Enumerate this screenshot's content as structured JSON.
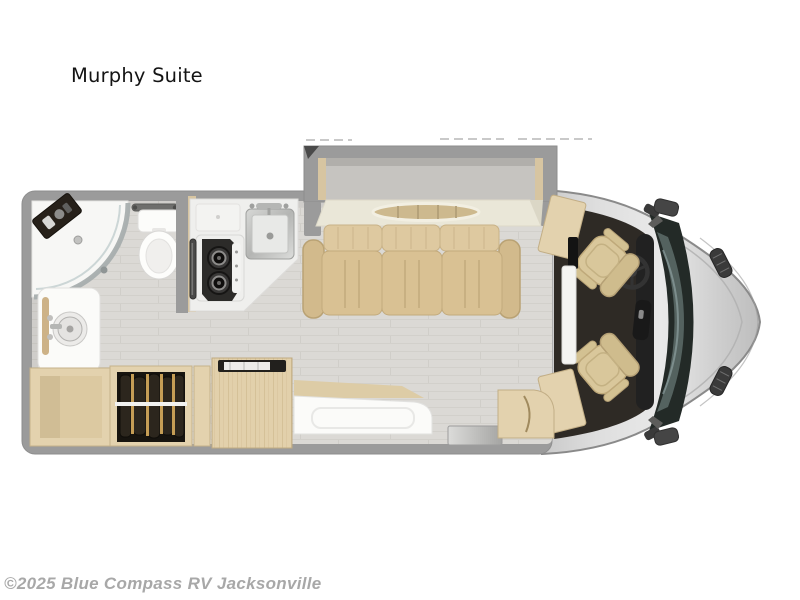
{
  "title": "Murphy Suite",
  "watermark": "©2025 Blue Compass RV Jacksonville",
  "colors": {
    "bg": "#ffffff",
    "ink": "#141414",
    "watermark_ink": "#a8a8a8",
    "wall": "#9b9b9b",
    "floor": "#dbd9d5",
    "wood": "#e3d2ae",
    "wood_edge": "#c6b28a",
    "counter": "#efefed",
    "cream": "#eae7d8",
    "mattress": "#c6c4c0",
    "upholstery": "#d9c193",
    "upholstery_edge": "#c2aa7c",
    "cab_floor": "#2e2a25",
    "body_silver": "#d9d9d9",
    "body_edge": "#8a8a8a",
    "glass": "#232a27",
    "glass_light": "#5a6866",
    "fixture_white": "#fbfbf9",
    "appliance_dark": "#2c2b29",
    "chrome": "#b5b6b4"
  }
}
